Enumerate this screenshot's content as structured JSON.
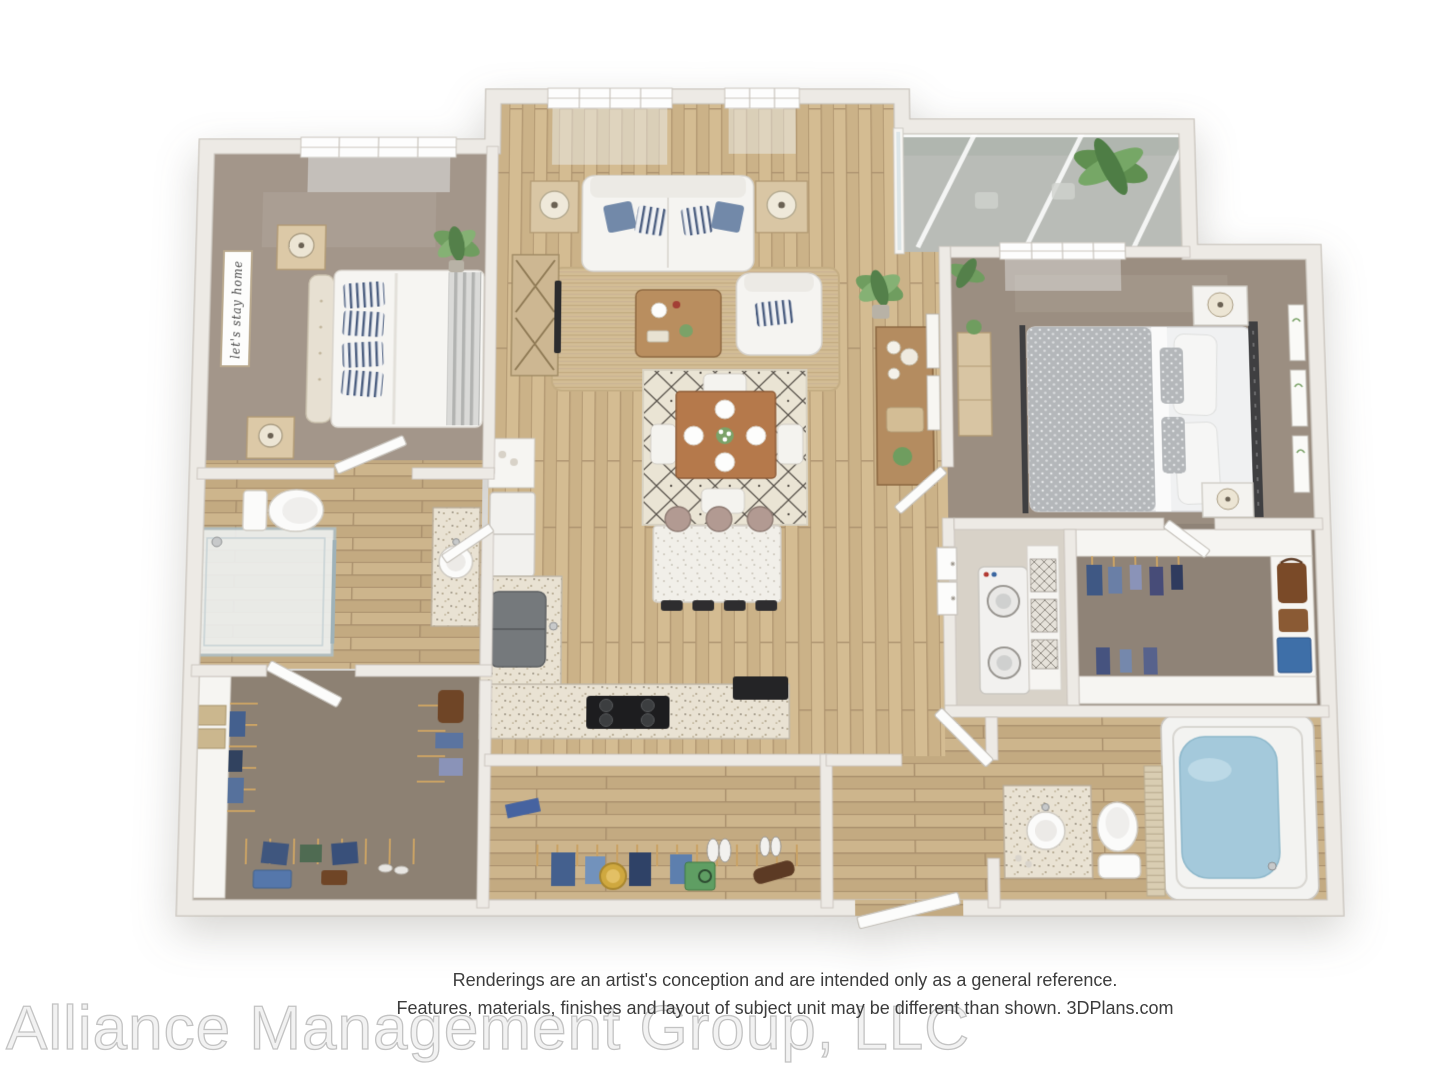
{
  "page": {
    "background": "#ffffff"
  },
  "disclaimer": {
    "line1": "Renderings are an artist's conception and are intended only as a general reference.",
    "line2": "Features, materials, finishes and layout of subject unit may be different than shown. 3DPlans.com"
  },
  "watermark": {
    "text": "Alliance Management Group, LLC"
  },
  "plan": {
    "type": "3d-rendered-floor-plan",
    "view": "top-down-isometric",
    "bedrooms": 2,
    "bathrooms": 2,
    "rooms": [
      "living-room",
      "dining-area",
      "kitchen",
      "balcony",
      "bedroom-1",
      "bathroom-1",
      "walk-in-closet-1",
      "bedroom-2",
      "bathroom-2",
      "walk-in-closet-2",
      "laundry-closet",
      "entry-hall-closet",
      "entry-vestibule"
    ],
    "decor": {
      "bedroom1_wall_sign": "let's stay home"
    },
    "colors": {
      "wall": "#edeae5",
      "walledge": "#c9c4bc",
      "wood": "#c9b086",
      "carpet": "#a3968a",
      "balconyfloor": "#b9bcb7",
      "jute": "#d3bd95",
      "rugdining": "#eae4d4",
      "accentblue": "#7289a9",
      "tubwater": "#a4c9db",
      "islandtop": "#f1efe9",
      "golddecor": "#cfa83f",
      "plantgreen": "#6f9d5f"
    }
  }
}
